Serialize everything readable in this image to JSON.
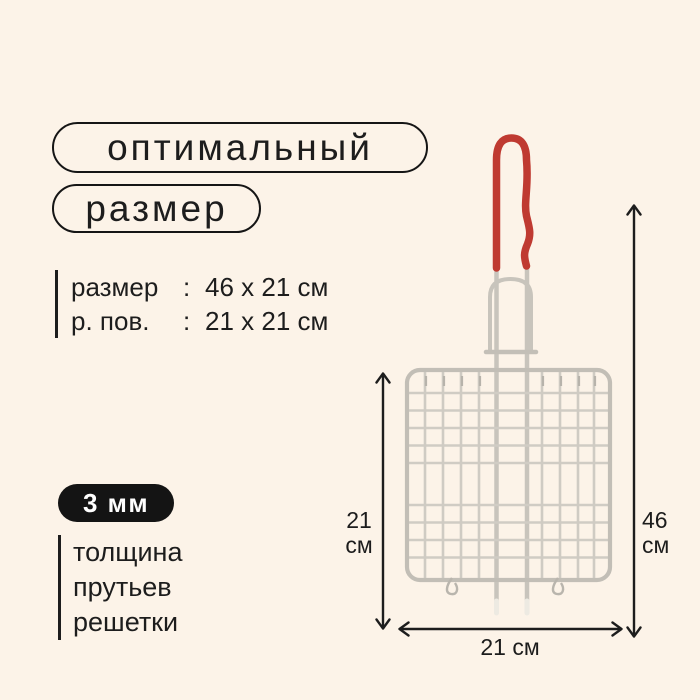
{
  "page": {
    "background": "#fcf3e8",
    "ink": "#1d1d1d"
  },
  "header": {
    "pills": [
      {
        "label": "оптимальный"
      },
      {
        "label": "размер"
      }
    ]
  },
  "specs": {
    "rows": [
      {
        "label": "размер",
        "separator": ":",
        "value": "46 x 21 см"
      },
      {
        "label": "р. пов.",
        "separator": ":",
        "value": "21 x 21 см"
      }
    ]
  },
  "thickness": {
    "badge": "3 мм",
    "caption_lines": [
      "толщина",
      "прутьев",
      "решетки"
    ]
  },
  "dimensions": {
    "left": {
      "value": "21",
      "unit": "см"
    },
    "right": {
      "value": "46",
      "unit": "см"
    },
    "bottom": {
      "label": "21 см"
    }
  },
  "illustration": {
    "name": "bbq-grill-basket-with-red-handle",
    "handle_color": "#bf3a31",
    "wire_color": "#c8c4bc",
    "frame_color": "#c2beb6",
    "arrow_color": "#1d1d1d"
  }
}
